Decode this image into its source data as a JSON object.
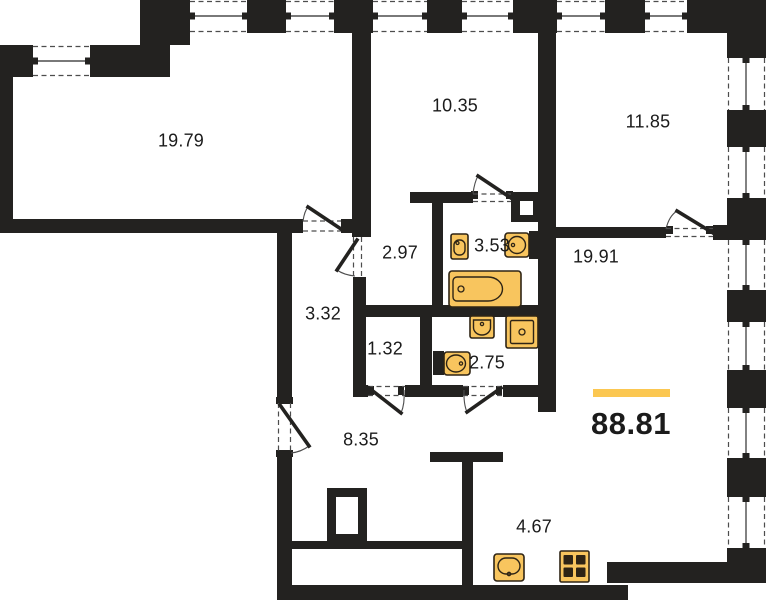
{
  "plan": {
    "total_area": "88.81",
    "rooms": [
      {
        "area": "19.79"
      },
      {
        "area": "10.35"
      },
      {
        "area": "11.85"
      },
      {
        "area": "2.97"
      },
      {
        "area": "3.53"
      },
      {
        "area": "19.91"
      },
      {
        "area": "3.32"
      },
      {
        "area": "1.32"
      },
      {
        "area": "2.75"
      },
      {
        "area": "8.35"
      },
      {
        "area": "4.67"
      }
    ],
    "icons": [
      "bathtub-icon",
      "toilet-icon",
      "toilet-icon",
      "washbasin-icon",
      "shower-tray-icon",
      "toilet-icon",
      "kitchen-sink-icon",
      "stove-icon"
    ]
  },
  "colors": {
    "wall": "#232220",
    "bg": "#ffffff",
    "line": "#4d4d4d",
    "ink": "#1b1b1b",
    "fixture": "#F8C55E",
    "fixture_outline": "#2E2415",
    "accent": "#FBC751"
  }
}
